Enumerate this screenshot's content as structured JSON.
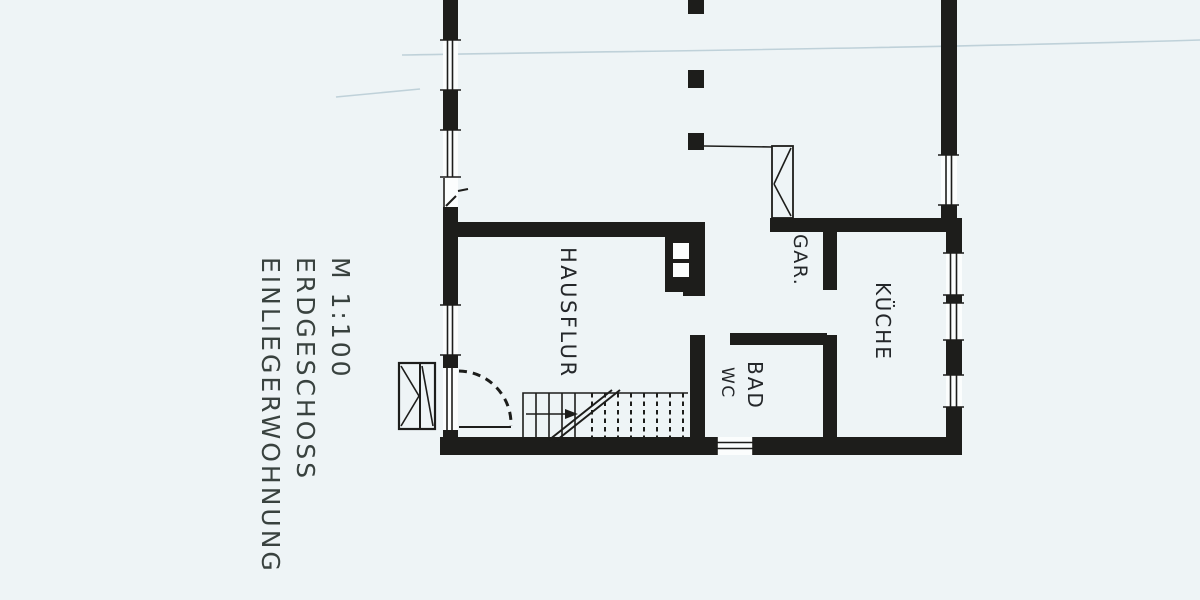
{
  "colors": {
    "paper": "#eef4f6",
    "ink": "#1d1d1b",
    "label_ink": "#24272a",
    "title_ink": "#39423f",
    "window_fill": "#fbfdfd",
    "crease": "#b9cdd6"
  },
  "title_block": {
    "scale": "M 1:100",
    "floor": "ERDGESCHOSS",
    "apartment": "EINLIEGERWOHNUNG"
  },
  "rooms": {
    "hallway": "HAUSFLUR",
    "cloakroom": "GAR.",
    "kitchen": "KÜCHE",
    "bath": "BAD",
    "wc": "WC"
  }
}
